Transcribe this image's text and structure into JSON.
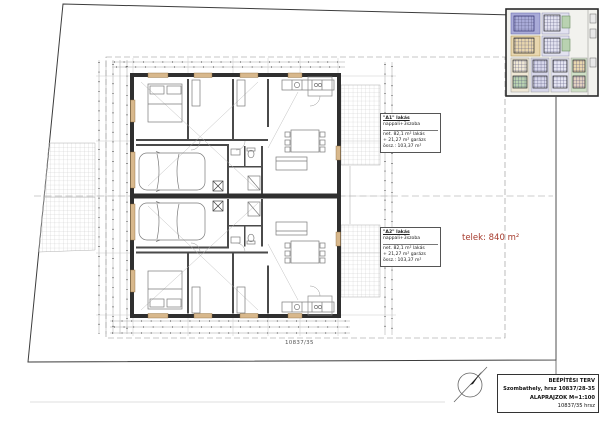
{
  "drawing": {
    "unit_a1_label": {
      "title": "\"A1\" lakás",
      "subtitle": "nappali+3szoba",
      "area_lines": [
        "net. 82,1 m² lakás",
        "+ 21,27 m² garázs",
        "össz.: 103,37 m²"
      ]
    },
    "unit_a2_label": {
      "title": "\"A2\" lakás",
      "subtitle": "nappali+3szoba",
      "area_lines": [
        "net. 82,1 m² lakás",
        "+ 21,27 m² garázs",
        "össz.: 103,37 m²"
      ]
    },
    "plot_area_label": "telek: 840 m²",
    "parcel_number": "10837/35",
    "title_block": {
      "project_type": "BEÉPÍTÉSI TERV",
      "location": "Szombathely, hrsz 10837/28-35",
      "sheet": "ALAPRAJZOK M=1:100",
      "parcel": "10837/35 hrsz"
    }
  },
  "colors": {
    "plot_text": "#a63a2c",
    "wall": "#2f2f2f",
    "window": "#d8b88c",
    "hatch": "#c8c8c8",
    "inset_blue": "#a9abd8",
    "inset_tan": "#e8d6ae",
    "inset_green": "#b9d2b1",
    "inset_lavender": "#e2e2f0"
  }
}
